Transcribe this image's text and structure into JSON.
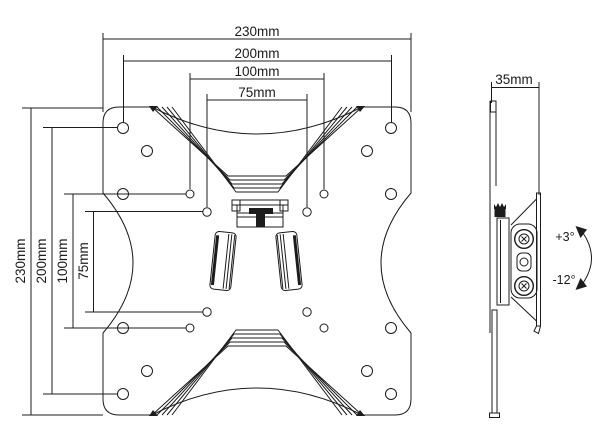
{
  "drawing": {
    "background": "#ffffff",
    "line_color": "#1c1c1c"
  },
  "front_view": {
    "width_dims": [
      {
        "label": "230mm"
      },
      {
        "label": "200mm"
      },
      {
        "label": "100mm"
      },
      {
        "label": "75mm"
      }
    ],
    "height_dims": [
      {
        "label": "230mm"
      },
      {
        "label": "200mm"
      },
      {
        "label": "100mm"
      },
      {
        "label": "75mm"
      }
    ]
  },
  "side_view": {
    "depth_dim": {
      "label": "35mm"
    },
    "tilt": {
      "up": "+3°",
      "down": "-12°"
    }
  }
}
